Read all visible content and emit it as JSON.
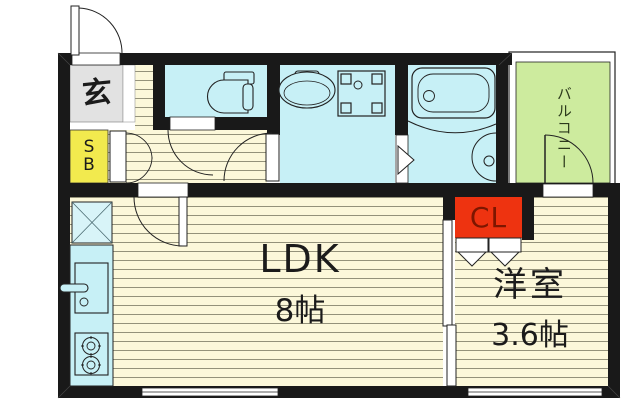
{
  "floorplan": {
    "type": "japanese-apartment-floor-plan",
    "rooms": {
      "entrance": {
        "label": "玄"
      },
      "shoe_box": {
        "label": "S\nB"
      },
      "ldk": {
        "label": "LDK",
        "size": "8帖"
      },
      "western_room": {
        "label": "洋室",
        "size": "3.6帖"
      },
      "closet": {
        "label": "CL"
      },
      "balcony": {
        "label": "バルコニー"
      }
    },
    "colors": {
      "wall": "#191919",
      "flooring": "#fcf8da",
      "flooring_stripe": "#94927a",
      "water_rooms": "#c7f0f6",
      "entrance_tile": "#e2e2e2",
      "shoe_box": "#f2ea4e",
      "closet_box": "#ee3310",
      "closet_text": "#7d1600",
      "balcony": "#cdeb9e"
    }
  }
}
